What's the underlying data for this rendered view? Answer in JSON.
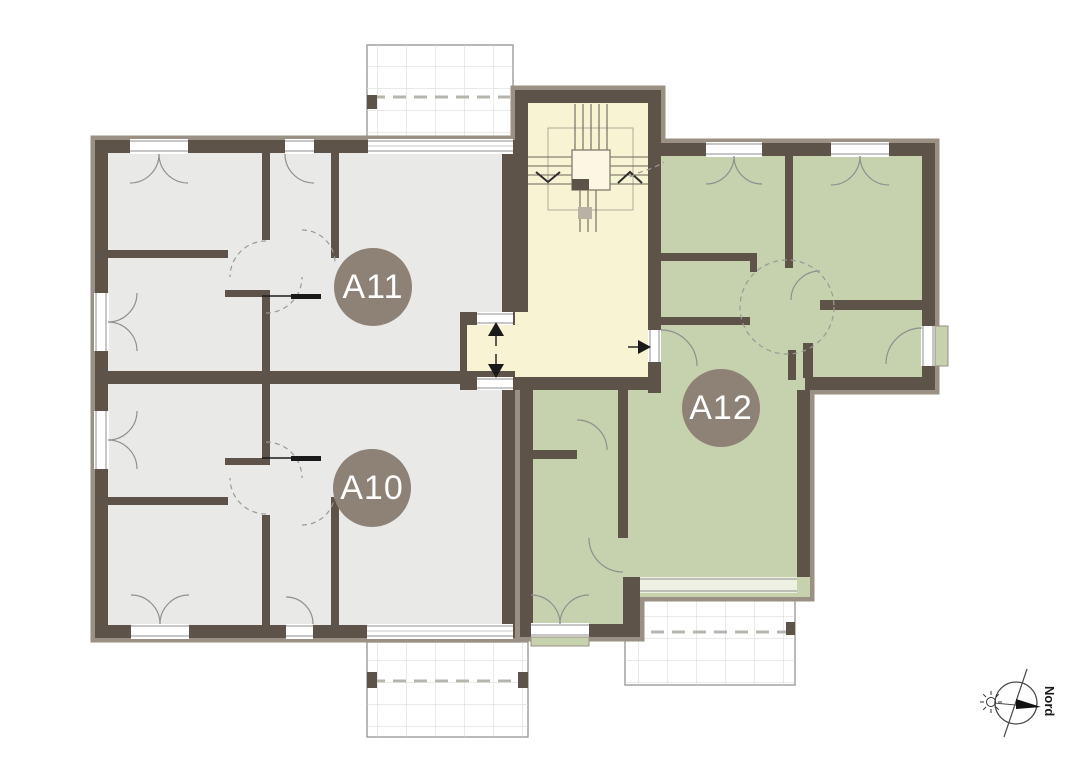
{
  "apartments": {
    "a11": {
      "label": "A11"
    },
    "a10": {
      "label": "A10"
    },
    "a12": {
      "label": "A12"
    }
  },
  "compass": {
    "north_label": "Nord"
  },
  "colors": {
    "wall": "#5d5349",
    "wall-band": "#9a9083",
    "room-gray": "#e9e9e8",
    "room-green": "#c6d1ad",
    "room-yellow": "#f8f3d3",
    "label-circle": "#8d8275",
    "label-text": "#ffffff",
    "terrace-border": "#9b9b9b",
    "terrace-grid": "#d6d6d6",
    "arc": "#8f8f8f",
    "dash": "#9a9a94",
    "ink": "#1a1a1a"
  }
}
